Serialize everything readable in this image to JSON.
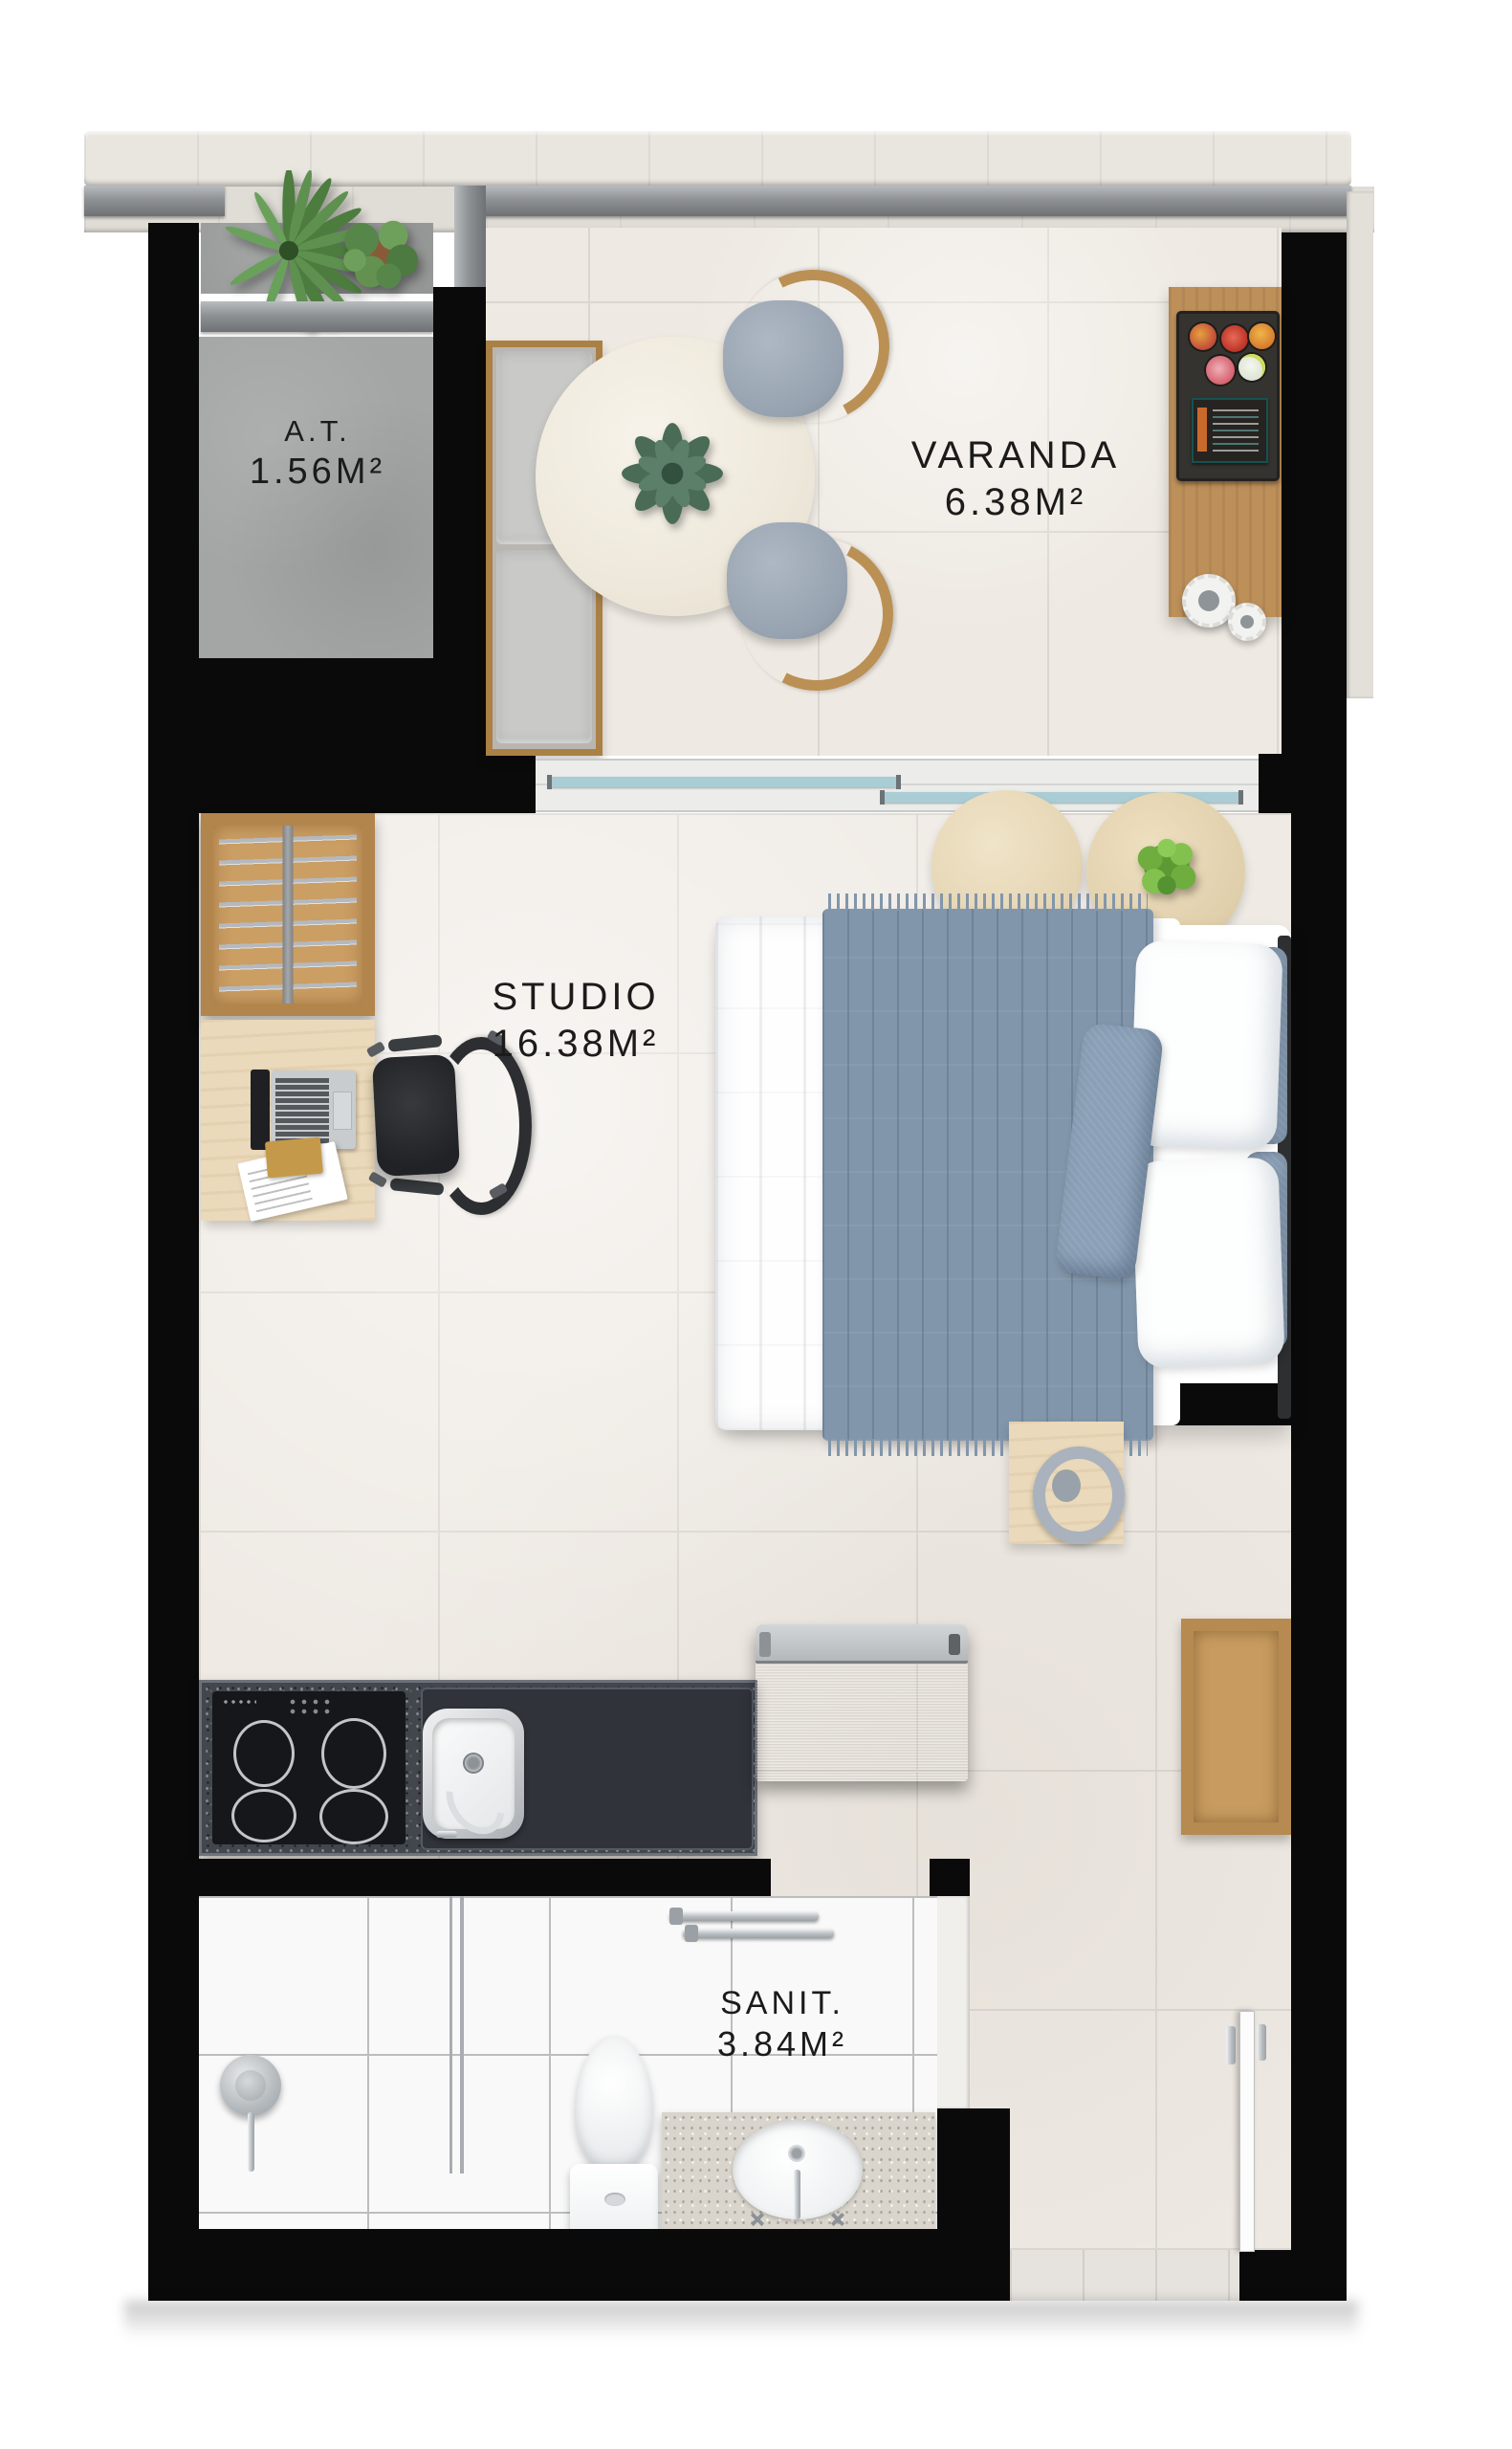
{
  "rooms": [
    {
      "id": "at",
      "label": "A.T.",
      "area": "1.56M²"
    },
    {
      "id": "varanda",
      "label": "VARANDA",
      "area": "6.38M²"
    },
    {
      "id": "studio",
      "label": "STUDIO",
      "area": "16.38M²"
    },
    {
      "id": "sanit",
      "label": "SANIT.",
      "area": "3.84M²"
    }
  ],
  "palette": {
    "wall": "#0a0a0a",
    "marble_floor": "#efeae4",
    "concrete_floor": "#a4a6a5",
    "bath_tile": "#f9f9f9",
    "wood": "#bd905a",
    "wood_light": "#ead9ba",
    "granite_dark": "#42464d",
    "granite_light": "#d9d5cc",
    "steel": "#a7abae",
    "glass": "#a9ccd5",
    "textile_blue": "#8296ab",
    "cushion_gray": "#c9c9c7",
    "plant_green": "#5e9150",
    "label_text": "#1b1b1b"
  },
  "furniture": [
    "planter-plants",
    "garden-bench",
    "dining-table",
    "succulent-centerpiece",
    "dining-chair",
    "bar-counter",
    "fruit-tray",
    "menu-board",
    "decor-plates",
    "sliding-glass-door",
    "clothes-rack",
    "desk",
    "laptop",
    "documents",
    "office-chair",
    "double-bed",
    "throw-blanket",
    "pillows",
    "headboard-cushions",
    "round-side-tables",
    "potted-plant",
    "bedside-table",
    "decor-ring",
    "kitchen-counter",
    "cooktop",
    "kitchen-sink",
    "refrigerator",
    "wall-shelf",
    "shower-mixer",
    "shower-screen",
    "toilet",
    "vanity-sink",
    "towel-bar",
    "entry-door"
  ]
}
